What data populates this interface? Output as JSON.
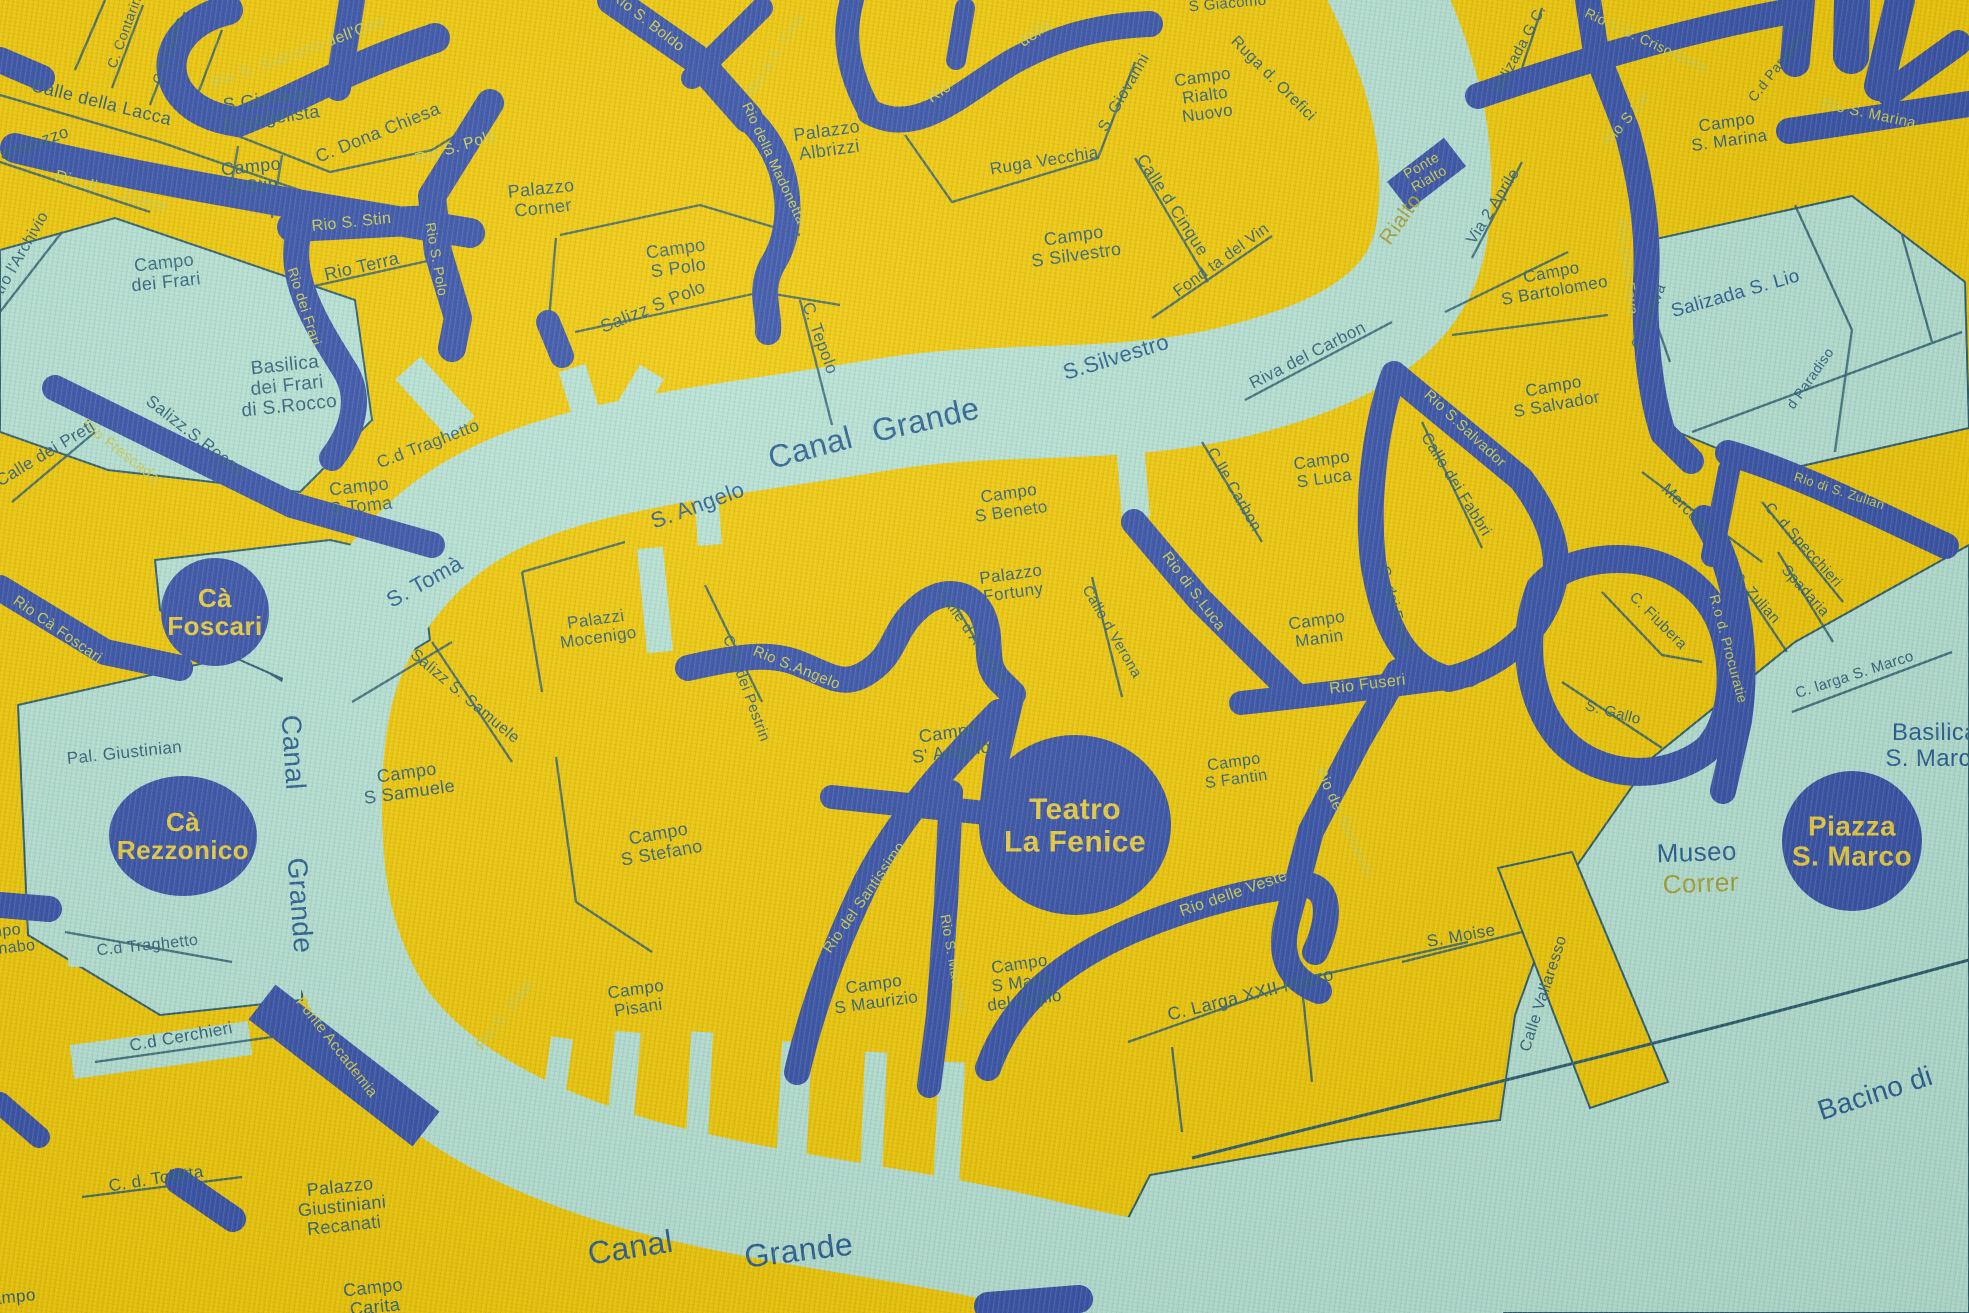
{
  "map": {
    "colors": {
      "land": "#eec90f",
      "water": "#b7e2d4",
      "rio": "#3b55a6",
      "street_line": "#2f6070",
      "street_text": "#33657a",
      "canal_text": "#2d6292",
      "rio_text": "#cdd052",
      "olive_text": "#a8a33c",
      "landmark_fill": "#3b55a6",
      "landmark_text": "#e9ce44"
    },
    "landmarks": [
      {
        "lines": [
          "Cà",
          "Foscari"
        ],
        "x": 215,
        "y": 612,
        "rx": 54,
        "ry": 54,
        "fs": 26
      },
      {
        "lines": [
          "Cà",
          "Rezzonico"
        ],
        "x": 183,
        "y": 836,
        "rx": 74,
        "ry": 60,
        "fs": 26
      },
      {
        "lines": [
          "Teatro",
          "La Fenice"
        ],
        "x": 1075,
        "y": 825,
        "rx": 96,
        "ry": 90,
        "fs": 30
      },
      {
        "lines": [
          "Piazza",
          "S. Marco"
        ],
        "x": 1852,
        "y": 841,
        "rx": 70,
        "ry": 70,
        "fs": 28
      }
    ],
    "labels": [
      {
        "k": "street",
        "t": "C. Contarina",
        "x": 130,
        "y": 30,
        "r": -70,
        "s": 14
      },
      {
        "k": "street",
        "t": "C.S Zuane",
        "x": 173,
        "y": 52,
        "r": -70,
        "s": 14
      },
      {
        "k": "rio",
        "t": "Rio di S. Zuane",
        "x": 110,
        "y": 196,
        "r": 16,
        "s": 16
      },
      {
        "k": "rio",
        "t": "Rio S. Giacomo dell'Orio",
        "x": 300,
        "y": 57,
        "r": -20,
        "s": 16
      },
      {
        "k": "street",
        "lines": [
          "S Giovanni",
          "Evangelista"
        ],
        "x": 270,
        "y": 108,
        "r": -8,
        "s": 18
      },
      {
        "k": "street",
        "t": "Calle della Lacca",
        "x": 100,
        "y": 108,
        "r": 14,
        "s": 18
      },
      {
        "k": "street",
        "t": "Campazzo",
        "x": 30,
        "y": 150,
        "r": -19,
        "s": 17
      },
      {
        "k": "street",
        "t": "C. Dona Chiesa",
        "x": 380,
        "y": 138,
        "r": -22,
        "s": 18
      },
      {
        "k": "street",
        "lines": [
          "Campo",
          "S Stin"
        ],
        "x": 252,
        "y": 176,
        "r": -6,
        "s": 18
      },
      {
        "k": "street",
        "t": "dietro l'Archivio",
        "x": 20,
        "y": 265,
        "r": -60,
        "s": 16
      },
      {
        "k": "street",
        "lines": [
          "Campo",
          "dei Frari"
        ],
        "x": 165,
        "y": 272,
        "r": -6,
        "s": 18
      },
      {
        "k": "street",
        "lines": [
          "Basilica",
          "dei Frari",
          "di S.Rocco"
        ],
        "x": 287,
        "y": 385,
        "r": -6,
        "s": 19
      },
      {
        "k": "street",
        "t": "Salizz.S.Rocco",
        "x": 192,
        "y": 440,
        "r": 38,
        "s": 17
      },
      {
        "k": "rio",
        "t": "Rio Frescada",
        "x": 118,
        "y": 455,
        "r": 38,
        "s": 15
      },
      {
        "k": "street",
        "t": "Calle dei Preti",
        "x": 48,
        "y": 458,
        "r": -31,
        "s": 17
      },
      {
        "k": "rio",
        "t": "Rio S. Stin",
        "x": 352,
        "y": 227,
        "r": -6,
        "s": 16
      },
      {
        "k": "rio",
        "t": "Rio S. Polo",
        "x": 457,
        "y": 152,
        "r": -17,
        "s": 16
      },
      {
        "k": "rio",
        "t": "Rio S. Polo",
        "x": 432,
        "y": 260,
        "r": 80,
        "s": 14
      },
      {
        "k": "rio",
        "t": "Rio dei Frari",
        "x": 300,
        "y": 308,
        "r": 72,
        "s": 14
      },
      {
        "k": "street",
        "t": "Rio Terra",
        "x": 363,
        "y": 272,
        "r": -13,
        "s": 18
      },
      {
        "k": "street",
        "lines": [
          "Palazzo",
          "Corner"
        ],
        "x": 542,
        "y": 198,
        "r": -6,
        "s": 18
      },
      {
        "k": "street",
        "lines": [
          "Campo",
          "S Polo"
        ],
        "x": 677,
        "y": 258,
        "r": -8,
        "s": 18
      },
      {
        "k": "street",
        "t": "Salizz S Polo",
        "x": 655,
        "y": 312,
        "r": -22,
        "s": 18
      },
      {
        "k": "street",
        "t": "C. Tepolo",
        "x": 815,
        "y": 340,
        "r": 70,
        "s": 17
      },
      {
        "k": "rio",
        "t": "Rio S. Boldo",
        "x": 645,
        "y": 25,
        "r": 38,
        "s": 15
      },
      {
        "k": "rio",
        "t": "Rio della Madonetta",
        "x": 770,
        "y": 165,
        "r": 65,
        "s": 14
      },
      {
        "k": "rio",
        "t": "Rio di S. Cass.",
        "x": 780,
        "y": 55,
        "r": -58,
        "s": 14
      },
      {
        "k": "street",
        "lines": [
          "Palazzo",
          "Albrizzi"
        ],
        "x": 828,
        "y": 140,
        "r": -8,
        "s": 18
      },
      {
        "k": "rio",
        "t": "Rio",
        "x": 942,
        "y": 96,
        "r": -35,
        "s": 16
      },
      {
        "k": "rio",
        "t": "delle",
        "x": 1038,
        "y": 37,
        "r": -35,
        "s": 16
      },
      {
        "k": "street",
        "t": "S Giacomo",
        "x": 1228,
        "y": 8,
        "r": -5,
        "s": 15
      },
      {
        "k": "street",
        "lines": [
          "Campo",
          "Rialto",
          "Nuovo"
        ],
        "x": 1205,
        "y": 95,
        "r": -8,
        "s": 17
      },
      {
        "k": "street",
        "t": "Ruga d. Orefici",
        "x": 1270,
        "y": 82,
        "r": 45,
        "s": 16
      },
      {
        "k": "street",
        "t": "Ruga Vecchia",
        "x": 1045,
        "y": 166,
        "r": -9,
        "s": 17
      },
      {
        "k": "street",
        "t": "S. Giovanni",
        "x": 1128,
        "y": 95,
        "r": -60,
        "s": 16
      },
      {
        "k": "street",
        "t": "Calle d Cinque",
        "x": 1168,
        "y": 208,
        "r": 57,
        "s": 17
      },
      {
        "k": "street",
        "lines": [
          "Campo",
          "S Silvestro"
        ],
        "x": 1075,
        "y": 245,
        "r": -8,
        "s": 18
      },
      {
        "k": "street",
        "t": "Fond ta del Vin",
        "x": 1224,
        "y": 264,
        "r": -36,
        "s": 16
      },
      {
        "k": "street",
        "t": "Riva del Carbon",
        "x": 1310,
        "y": 360,
        "r": -27,
        "s": 17
      },
      {
        "k": "canal",
        "t": "S.Silvestro",
        "x": 1118,
        "y": 364,
        "r": -17,
        "s": 22
      },
      {
        "k": "canal",
        "t": "Canal",
        "x": 813,
        "y": 458,
        "r": -15,
        "s": 32
      },
      {
        "k": "canal",
        "t": "Grande",
        "x": 928,
        "y": 430,
        "r": -13,
        "s": 32
      },
      {
        "k": "canal",
        "t": "S. Angelo",
        "x": 700,
        "y": 512,
        "r": -20,
        "s": 22
      },
      {
        "k": "canal",
        "t": "S. Tomà",
        "x": 428,
        "y": 588,
        "r": -29,
        "s": 22
      },
      {
        "k": "street",
        "t": "C.d Traghetto",
        "x": 430,
        "y": 449,
        "r": -21,
        "s": 17
      },
      {
        "k": "street",
        "lines": [
          "Campo",
          "S Toma"
        ],
        "x": 360,
        "y": 496,
        "r": -6,
        "s": 18
      },
      {
        "k": "rio",
        "t": "Rio Cà Foscari",
        "x": 55,
        "y": 633,
        "r": 35,
        "s": 15
      },
      {
        "k": "street",
        "t": "Pal. Giustinian",
        "x": 125,
        "y": 758,
        "r": -6,
        "s": 17
      },
      {
        "k": "canal",
        "t": "Canal",
        "x": 284,
        "y": 753,
        "r": 86,
        "s": 28
      },
      {
        "k": "canal",
        "t": "Grande",
        "x": 291,
        "y": 906,
        "r": 86,
        "s": 28
      },
      {
        "k": "street",
        "lines": [
          "Campo",
          "S Samuele"
        ],
        "x": 408,
        "y": 782,
        "r": -8,
        "s": 18
      },
      {
        "k": "street",
        "t": "Salizz S. Samuele",
        "x": 462,
        "y": 700,
        "r": 40,
        "s": 16
      },
      {
        "k": "street",
        "lines": [
          "Palazzi",
          "Mocenigo"
        ],
        "x": 597,
        "y": 628,
        "r": -8,
        "s": 17
      },
      {
        "k": "street",
        "t": "C.lle dei Pestrin",
        "x": 742,
        "y": 690,
        "r": 70,
        "s": 15
      },
      {
        "k": "rio",
        "t": "Rio S.Angelo",
        "x": 795,
        "y": 672,
        "r": 22,
        "s": 15
      },
      {
        "k": "street",
        "lines": [
          "Campo",
          "S' Angelo"
        ],
        "x": 950,
        "y": 742,
        "r": -8,
        "s": 18
      },
      {
        "k": "street",
        "t": "Calle d Avvocati",
        "x": 970,
        "y": 640,
        "r": 55,
        "s": 15
      },
      {
        "k": "street",
        "lines": [
          "Palazzo",
          "Fortuny"
        ],
        "x": 1012,
        "y": 583,
        "r": -8,
        "s": 17
      },
      {
        "k": "street",
        "t": "Calle d Verona",
        "x": 1108,
        "y": 634,
        "r": 60,
        "s": 15
      },
      {
        "k": "street",
        "lines": [
          "Campo",
          "S Beneto"
        ],
        "x": 1010,
        "y": 502,
        "r": -8,
        "s": 17
      },
      {
        "k": "rio",
        "t": "Rio di S.Luca",
        "x": 1190,
        "y": 594,
        "r": 53,
        "s": 15
      },
      {
        "k": "street",
        "lines": [
          "Campo",
          "S Luca"
        ],
        "x": 1323,
        "y": 469,
        "r": -8,
        "s": 17
      },
      {
        "k": "street",
        "t": "C.lle Carbon",
        "x": 1230,
        "y": 492,
        "r": 60,
        "s": 16
      },
      {
        "k": "street",
        "t": "Calle dei Fabbri",
        "x": 1452,
        "y": 487,
        "r": 58,
        "s": 16
      },
      {
        "k": "rio",
        "t": "Rio S.Salvador",
        "x": 1462,
        "y": 432,
        "r": 43,
        "s": 15
      },
      {
        "k": "street",
        "lines": [
          "Campo",
          "S Salvador"
        ],
        "x": 1555,
        "y": 395,
        "r": -10,
        "s": 17
      },
      {
        "k": "street",
        "lines": [
          "Campo",
          "S Bartolomeo"
        ],
        "x": 1553,
        "y": 281,
        "r": -10,
        "s": 17
      },
      {
        "k": "street",
        "t": "Via 2 Aprile",
        "x": 1497,
        "y": 209,
        "r": -58,
        "s": 16
      },
      {
        "k": "street",
        "t": "Salizada G.C.",
        "x": 1523,
        "y": 52,
        "r": -62,
        "s": 15
      },
      {
        "k": "olive",
        "t": "Rialto",
        "x": 1406,
        "y": 223,
        "r": -55,
        "s": 21
      },
      {
        "k": "rio",
        "lines": [
          "Ponte",
          "Rialto"
        ],
        "x": 1425,
        "y": 172,
        "r": -30,
        "s": 14
      },
      {
        "k": "rio",
        "t": "Rio S.G. Crisostomo",
        "x": 1645,
        "y": 45,
        "r": 25,
        "s": 14
      },
      {
        "k": "street",
        "lines": [
          "Campo",
          "S. Marina"
        ],
        "x": 1728,
        "y": 131,
        "r": -8,
        "s": 17
      },
      {
        "k": "rio",
        "t": "Rio S. Marina",
        "x": 1868,
        "y": 118,
        "r": 12,
        "s": 15
      },
      {
        "k": "rio",
        "t": "Rio S Lio",
        "x": 1630,
        "y": 122,
        "r": -50,
        "s": 15
      },
      {
        "k": "rio",
        "t": "Rio della Fava",
        "x": 1623,
        "y": 268,
        "r": 83,
        "s": 14
      },
      {
        "k": "street",
        "t": "C. d Fava",
        "x": 1653,
        "y": 318,
        "r": -68,
        "s": 15
      },
      {
        "k": "canal",
        "t": "Salizada S. Lio",
        "x": 1737,
        "y": 299,
        "r": -16,
        "s": 19
      },
      {
        "k": "street",
        "t": "C.d Paradiso",
        "x": 1781,
        "y": 69,
        "r": -52,
        "s": 14
      },
      {
        "k": "street",
        "t": "d Paradiso",
        "x": 1814,
        "y": 381,
        "r": -55,
        "s": 14
      },
      {
        "k": "rio",
        "t": "Rio di S. Zulian",
        "x": 1838,
        "y": 495,
        "r": 18,
        "s": 13
      },
      {
        "k": "street",
        "t": "Mercerie",
        "x": 1684,
        "y": 513,
        "r": 45,
        "s": 16
      },
      {
        "k": "street",
        "t": "C. d Specchieri",
        "x": 1800,
        "y": 548,
        "r": 48,
        "s": 15
      },
      {
        "k": "street",
        "t": "Spadaria",
        "x": 1802,
        "y": 594,
        "r": 48,
        "s": 15
      },
      {
        "k": "street",
        "t": "S. Zulian",
        "x": 1753,
        "y": 601,
        "r": 48,
        "s": 15
      },
      {
        "k": "street",
        "t": "C. Fiubera",
        "x": 1655,
        "y": 624,
        "r": 45,
        "s": 15
      },
      {
        "k": "street",
        "t": "S. Gallo",
        "x": 1612,
        "y": 717,
        "r": 15,
        "s": 15
      },
      {
        "k": "street",
        "t": "C. larga S. Marco",
        "x": 1856,
        "y": 679,
        "r": -18,
        "s": 15
      },
      {
        "k": "rio",
        "t": "R.o d. Procuratie",
        "x": 1724,
        "y": 650,
        "r": 75,
        "s": 14
      },
      {
        "k": "canal",
        "lines": [
          "Basilica",
          "S. Marco"
        ],
        "x": 1935,
        "y": 745,
        "r": 0,
        "s": 24
      },
      {
        "k": "canal",
        "t": "Museo",
        "x": 1697,
        "y": 861,
        "r": -2,
        "s": 26
      },
      {
        "k": "olive",
        "t": "Correr",
        "x": 1701,
        "y": 892,
        "r": -2,
        "s": 26
      },
      {
        "k": "street",
        "lines": [
          "Campo",
          "Manin"
        ],
        "x": 1318,
        "y": 629,
        "r": -8,
        "s": 17
      },
      {
        "k": "street",
        "t": "C. dei Fuseri",
        "x": 1391,
        "y": 611,
        "r": 75,
        "s": 15
      },
      {
        "k": "rio",
        "t": "Rio Fuseri",
        "x": 1368,
        "y": 689,
        "r": -7,
        "s": 16
      },
      {
        "k": "rio",
        "t": "Rio dei Barcaroli",
        "x": 1340,
        "y": 823,
        "r": 65,
        "s": 15
      },
      {
        "k": "street",
        "lines": [
          "Campo",
          "S Fantin"
        ],
        "x": 1235,
        "y": 770,
        "r": -8,
        "s": 16
      },
      {
        "k": "rio",
        "t": "Rio delle Veste",
        "x": 1235,
        "y": 898,
        "r": -19,
        "s": 16
      },
      {
        "k": "street",
        "t": "S. Moise",
        "x": 1462,
        "y": 941,
        "r": -10,
        "s": 17
      },
      {
        "k": "street",
        "t": "Calle Vallaresso",
        "x": 1548,
        "y": 995,
        "r": -72,
        "s": 16
      },
      {
        "k": "street",
        "t": "C. Larga XXII Marzo",
        "x": 1252,
        "y": 1000,
        "r": -14,
        "s": 18
      },
      {
        "k": "street",
        "lines": [
          "Campo",
          "S Maria",
          "del Giglio"
        ],
        "x": 1022,
        "y": 982,
        "r": -8,
        "s": 17
      },
      {
        "k": "street",
        "lines": [
          "Campo",
          "S Maurizio"
        ],
        "x": 875,
        "y": 993,
        "r": -8,
        "s": 17
      },
      {
        "k": "rio",
        "t": "Rio S. Maurizio",
        "x": 949,
        "y": 965,
        "r": 80,
        "s": 14
      },
      {
        "k": "rio",
        "t": "Rio del Santissimo",
        "x": 868,
        "y": 900,
        "r": -55,
        "s": 15
      },
      {
        "k": "street",
        "lines": [
          "Campo",
          "S Stefano"
        ],
        "x": 660,
        "y": 843,
        "r": -10,
        "s": 18
      },
      {
        "k": "street",
        "lines": [
          "Campo",
          "Pisani"
        ],
        "x": 637,
        "y": 998,
        "r": -8,
        "s": 17
      },
      {
        "k": "rio",
        "t": "Rio S. Vidal",
        "x": 508,
        "y": 1018,
        "r": -52,
        "s": 15
      },
      {
        "k": "rio",
        "t": "Ponte Accademia",
        "x": 333,
        "y": 1050,
        "r": 52,
        "s": 15
      },
      {
        "k": "street",
        "lines": [
          "Campo",
          "S Barnabo"
        ],
        "x": -5,
        "y": 940,
        "r": -6,
        "s": 16
      },
      {
        "k": "street",
        "t": "C.d Traghetto",
        "x": 148,
        "y": 950,
        "r": -6,
        "s": 16
      },
      {
        "k": "street",
        "t": "C.d Cerchieri",
        "x": 182,
        "y": 1042,
        "r": -10,
        "s": 17
      },
      {
        "k": "street",
        "t": "C. d. Toletta",
        "x": 157,
        "y": 1184,
        "r": -9,
        "s": 17
      },
      {
        "k": "street",
        "lines": [
          "Palazzo",
          "Giustiniani",
          "Recanati"
        ],
        "x": 342,
        "y": 1206,
        "r": -6,
        "s": 18
      },
      {
        "k": "street",
        "lines": [
          "Campo",
          "Carita"
        ],
        "x": 374,
        "y": 1297,
        "r": -6,
        "s": 18
      },
      {
        "k": "street",
        "t": "Campo",
        "x": 8,
        "y": 1303,
        "r": -6,
        "s": 17
      },
      {
        "k": "canal",
        "t": "Canal",
        "x": 632,
        "y": 1258,
        "r": -9,
        "s": 32
      },
      {
        "k": "canal",
        "t": "Grande",
        "x": 800,
        "y": 1261,
        "r": -7,
        "s": 32
      },
      {
        "k": "canal",
        "t": "Bacino di",
        "x": 1878,
        "y": 1102,
        "r": -18,
        "s": 28
      }
    ]
  }
}
